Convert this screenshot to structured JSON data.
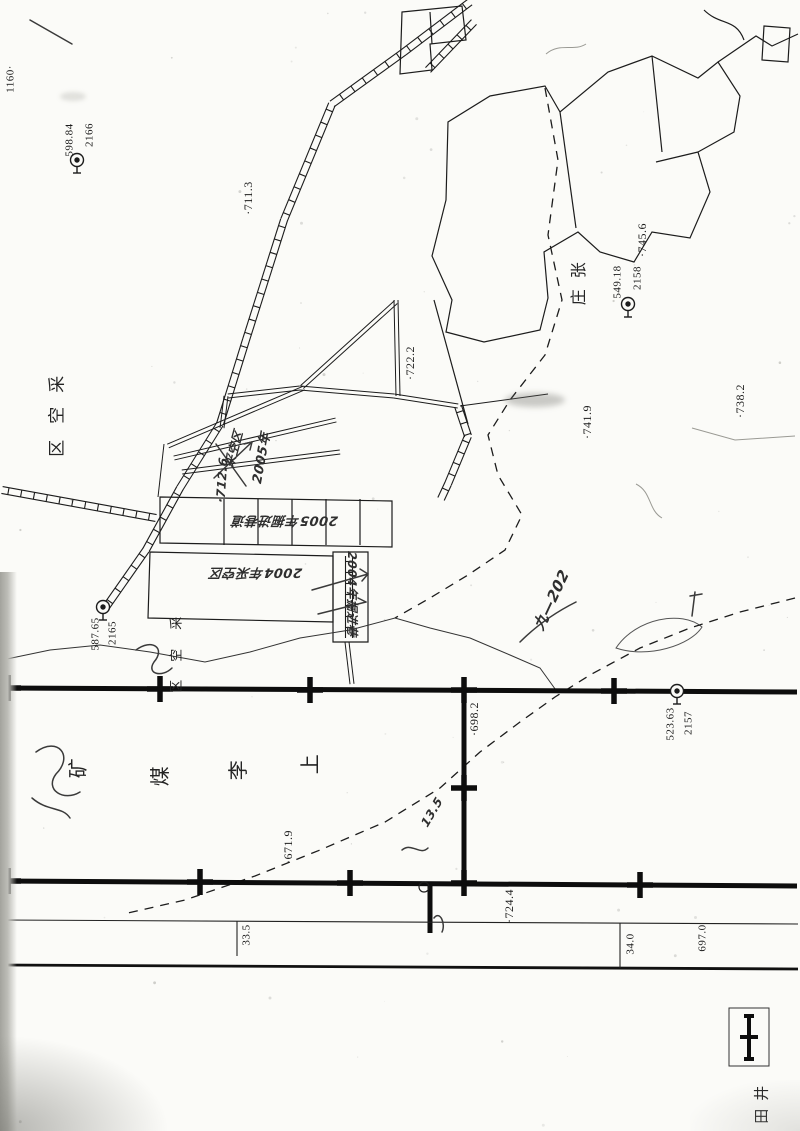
{
  "document": {
    "kind_label": "采掘工程平面图(扫描件)",
    "mine_name_chars": [
      "上",
      "李",
      "煤",
      "矿"
    ]
  },
  "colors": {
    "paper": "#fbfbf8",
    "ink": "#1c1c1c",
    "boundary": "#0d0d0d",
    "hand": "#2f2f2f",
    "faint": "#9a9a94"
  },
  "legend": {
    "symbol": "mine-boundary-line-with-crosses",
    "label_chars": [
      "井",
      "田"
    ]
  },
  "benchmarks": [
    {
      "id": "2166",
      "elevation": "598.84",
      "x": 77,
      "y": 160
    },
    {
      "id": "2158",
      "elevation": "549.18",
      "x": 628,
      "y": 304
    },
    {
      "id": "2165",
      "elevation": "587.65",
      "x": 103,
      "y": 607
    },
    {
      "id": "2157",
      "elevation": "523.63",
      "x": 677,
      "y": 691
    }
  ],
  "labels": [
    {
      "name": "edge-number",
      "text": "1160·",
      "x": 11,
      "y": 79,
      "rot": -90,
      "size": 11,
      "style": "print"
    },
    {
      "name": "benchmark-2166-id",
      "text": "2166",
      "x": 90,
      "y": 135,
      "rot": -90,
      "size": 11,
      "style": "print"
    },
    {
      "name": "benchmark-2166-elev",
      "text": "598.84",
      "x": 70,
      "y": 140,
      "rot": -90,
      "size": 11,
      "style": "print"
    },
    {
      "name": "spot-height-711",
      "text": "·711.3",
      "x": 248,
      "y": 198,
      "rot": -90,
      "size": 12,
      "style": "print"
    },
    {
      "name": "spot-height-745",
      "text": "·745.6",
      "x": 642,
      "y": 240,
      "rot": -90,
      "size": 12,
      "style": "print"
    },
    {
      "name": "benchmark-2158-id",
      "text": "2158",
      "x": 638,
      "y": 278,
      "rot": -90,
      "size": 11,
      "style": "print"
    },
    {
      "name": "benchmark-2158-elev",
      "text": "549.18",
      "x": 618,
      "y": 282,
      "rot": -90,
      "size": 11,
      "style": "print"
    },
    {
      "name": "village-name-char",
      "text": "张",
      "x": 579,
      "y": 270,
      "rot": -90,
      "size": 16,
      "style": "big"
    },
    {
      "name": "village-name-char",
      "text": "庄",
      "x": 579,
      "y": 297,
      "rot": -90,
      "size": 16,
      "style": "big"
    },
    {
      "name": "spot-height-722",
      "text": "·722.2",
      "x": 410,
      "y": 363,
      "rot": -90,
      "size": 12,
      "style": "print"
    },
    {
      "name": "spot-height-741",
      "text": "·741.9",
      "x": 587,
      "y": 422,
      "rot": -90,
      "size": 12,
      "style": "print"
    },
    {
      "name": "spot-height-738",
      "text": "·738.2",
      "x": 740,
      "y": 401,
      "rot": -90,
      "size": 12,
      "style": "print"
    },
    {
      "name": "gob-area-char",
      "text": "采",
      "x": 58,
      "y": 384,
      "rot": -90,
      "size": 17,
      "style": "big"
    },
    {
      "name": "gob-area-char",
      "text": "空",
      "x": 58,
      "y": 415,
      "rot": -90,
      "size": 17,
      "style": "big"
    },
    {
      "name": "gob-area-char",
      "text": "区",
      "x": 58,
      "y": 448,
      "rot": -90,
      "size": 17,
      "style": "big"
    },
    {
      "name": "hand-year-2005",
      "text": "2005年",
      "x": 262,
      "y": 458,
      "rot": -80,
      "size": 13,
      "style": "hand"
    },
    {
      "name": "hand-gob-note",
      "text": "采空区",
      "x": 234,
      "y": 449,
      "rot": -75,
      "size": 12,
      "style": "hand"
    },
    {
      "name": "hand-elev-712",
      "text": "·712.6",
      "x": 222,
      "y": 480,
      "rot": -86,
      "size": 12,
      "style": "hand"
    },
    {
      "name": "hand-2005-heading-note",
      "text": "2005年掘进巷道",
      "x": 285,
      "y": 520,
      "rot": 180,
      "size": 13,
      "style": "hand"
    },
    {
      "name": "hand-2004-gob-note",
      "text": "2004年采空区",
      "x": 256,
      "y": 572,
      "rot": 180,
      "size": 13,
      "style": "hand"
    },
    {
      "name": "hand-2004-heading-note",
      "text": "2004年掘进巷",
      "x": 352,
      "y": 594,
      "rot": 90,
      "size": 12,
      "style": "hand"
    },
    {
      "name": "benchmark-2165-id",
      "text": "2165",
      "x": 113,
      "y": 633,
      "rot": -90,
      "size": 11,
      "style": "print"
    },
    {
      "name": "benchmark-2165-elev",
      "text": "587.65",
      "x": 96,
      "y": 634,
      "rot": -90,
      "size": 11,
      "style": "print"
    },
    {
      "name": "gob-area-char",
      "text": "采",
      "x": 177,
      "y": 623,
      "rot": -90,
      "size": 13,
      "style": "big"
    },
    {
      "name": "gob-area-char",
      "text": "空",
      "x": 177,
      "y": 655,
      "rot": -90,
      "size": 13,
      "style": "big"
    },
    {
      "name": "gob-area-char",
      "text": "区",
      "x": 177,
      "y": 686,
      "rot": -90,
      "size": 13,
      "style": "big"
    },
    {
      "name": "hand-seam-note",
      "text": "九—202",
      "x": 552,
      "y": 600,
      "rot": -65,
      "size": 15,
      "style": "hand"
    },
    {
      "name": "spot-height-698",
      "text": "·698.2",
      "x": 474,
      "y": 719,
      "rot": -90,
      "size": 12,
      "style": "print"
    },
    {
      "name": "benchmark-2157-id",
      "text": "2157",
      "x": 689,
      "y": 723,
      "rot": -90,
      "size": 11,
      "style": "print"
    },
    {
      "name": "benchmark-2157-elev",
      "text": "523.63",
      "x": 671,
      "y": 724,
      "rot": -90,
      "size": 11,
      "style": "print"
    },
    {
      "name": "mine-name-char",
      "text": "上",
      "x": 310,
      "y": 764,
      "rot": -90,
      "size": 20,
      "style": "big"
    },
    {
      "name": "mine-name-char",
      "text": "李",
      "x": 238,
      "y": 770,
      "rot": -90,
      "size": 20,
      "style": "big"
    },
    {
      "name": "mine-name-char",
      "text": "煤",
      "x": 160,
      "y": 776,
      "rot": -90,
      "size": 20,
      "style": "big"
    },
    {
      "name": "mine-name-char",
      "text": "矿",
      "x": 78,
      "y": 768,
      "rot": -90,
      "size": 20,
      "style": "big"
    },
    {
      "name": "hand-measure-note",
      "text": "13.5",
      "x": 432,
      "y": 812,
      "rot": -60,
      "size": 12,
      "style": "hand"
    },
    {
      "name": "spot-height-671",
      "text": "·671.9",
      "x": 288,
      "y": 847,
      "rot": -90,
      "size": 12,
      "style": "print"
    },
    {
      "name": "spot-height-724",
      "text": "·724.4",
      "x": 509,
      "y": 906,
      "rot": -90,
      "size": 12,
      "style": "print"
    },
    {
      "name": "chainage-33-5",
      "text": "33.5",
      "x": 247,
      "y": 935,
      "rot": -90,
      "size": 11,
      "style": "print"
    },
    {
      "name": "chainage-34-0",
      "text": "34.0",
      "x": 631,
      "y": 944,
      "rot": -90,
      "size": 11,
      "style": "print"
    },
    {
      "name": "spot-height-697",
      "text": "697.0",
      "x": 703,
      "y": 938,
      "rot": -90,
      "size": 11,
      "style": "print"
    },
    {
      "name": "legend-label-char",
      "text": "井",
      "x": 762,
      "y": 1093,
      "rot": -90,
      "size": 15,
      "style": "big"
    },
    {
      "name": "legend-label-char",
      "text": "田",
      "x": 762,
      "y": 1116,
      "rot": -90,
      "size": 15,
      "style": "big"
    }
  ]
}
